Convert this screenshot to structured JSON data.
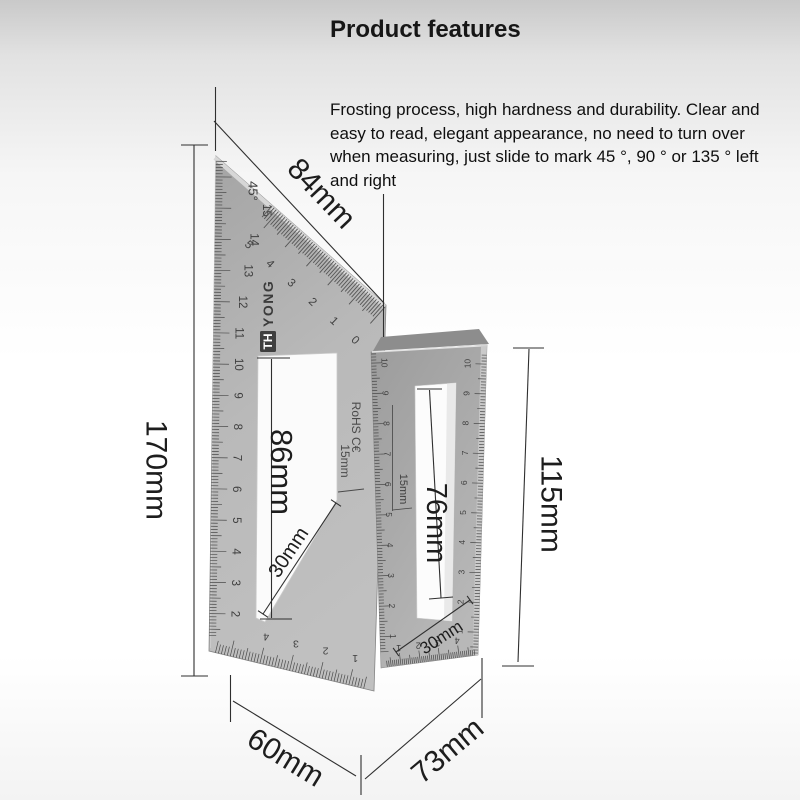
{
  "header": {
    "title": "Product features",
    "description": "Frosting process, high hardness and durability. Clear and easy to read, elegant appearance, no need to turn over when measuring, just slide to mark 45 °, 90 ° or 135 ° left and right"
  },
  "dimension_labels": {
    "hypotenuse": "84mm",
    "left_height": "170mm",
    "triangle_slot_length": "86mm",
    "triangle_slot_width": "30mm",
    "bar_height": "115mm",
    "bar_slot_length": "76mm",
    "bar_slot_width": "30mm",
    "bar_thickness": "15mm",
    "base_depth": "60mm",
    "base_width": "73mm"
  },
  "tool_markings": {
    "angle": "45°",
    "brand_prefix": "TH",
    "brand_suffix": "YONG",
    "certification": "RoHS C€",
    "thickness": "15mm",
    "triangle_left_scale": [
      "1",
      "2",
      "3",
      "4",
      "5",
      "6",
      "7",
      "8",
      "9",
      "10",
      "11",
      "12",
      "13",
      "14",
      "15"
    ],
    "hypotenuse_scale": [
      "0",
      "1",
      "2",
      "3",
      "4",
      "5"
    ],
    "triangle_bottom_scale": [
      "1",
      "2",
      "3",
      "4"
    ],
    "bar_left_scale": [
      "1",
      "2",
      "3",
      "4",
      "5",
      "6",
      "7",
      "8",
      "9",
      "10"
    ],
    "bar_right_scale": [
      "1",
      "2",
      "3",
      "4",
      "5",
      "6",
      "7",
      "8",
      "9",
      "10"
    ],
    "bar_bottom_scale": [
      "1",
      "2",
      "3",
      "4"
    ]
  },
  "colors": {
    "background_top": "#c9c9c9",
    "metal_light": "#bcbcbc",
    "metal_dark": "#8d8d8d",
    "annotation": "#2f2f2f"
  }
}
